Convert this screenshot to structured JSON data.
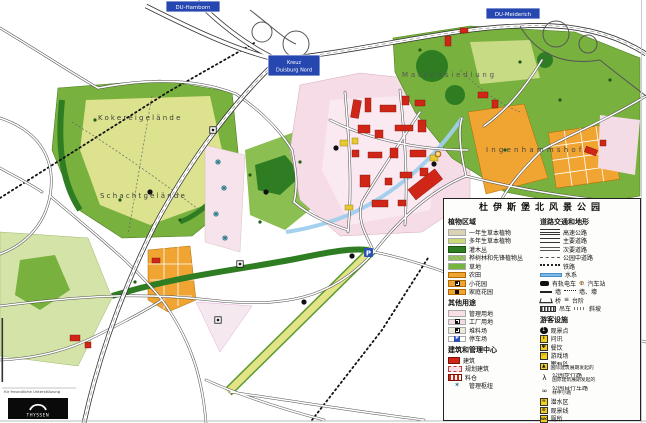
{
  "legend": {
    "title": "杜伊斯堡北风景公园",
    "plants": {
      "header": "植物区域",
      "items": [
        {
          "label": "一年生草本植物"
        },
        {
          "label": "多年生草本植物"
        },
        {
          "label": "灌木丛"
        },
        {
          "label": "桦树林和先锋植物丛"
        },
        {
          "label": "草地"
        },
        {
          "label": "农田"
        },
        {
          "label": "小花园"
        },
        {
          "label": "家庭花园"
        }
      ]
    },
    "other": {
      "header": "其他用途",
      "items": [
        {
          "label": "管理用地"
        },
        {
          "label": "工厂用地"
        },
        {
          "label": "堆料场"
        },
        {
          "label": "停车场",
          "glyph": "P"
        }
      ]
    },
    "buildings": {
      "header": "建筑和管理中心",
      "items": [
        {
          "label": "建筑"
        },
        {
          "label": "规划建筑"
        },
        {
          "label": "料仓"
        },
        {
          "label": "管理枢纽",
          "glyph": "✶"
        }
      ]
    },
    "roads": {
      "header": "道路交通和地形",
      "items": [
        {
          "label": "高速公路"
        },
        {
          "label": "主要道路"
        },
        {
          "label": "次要道路"
        },
        {
          "label": "公园中道路"
        },
        {
          "label": "铁路"
        },
        {
          "label": "水系"
        },
        {
          "label": "有轨电车",
          "label2": "汽车站",
          "glyph2": "⊕"
        },
        {
          "label": "墙",
          "label2": "墙、壕"
        },
        {
          "label": "桥",
          "label2": "台阶",
          "glyph2": "≡"
        },
        {
          "label": "吊车",
          "label2": "斜坡"
        }
      ]
    },
    "facilities": {
      "header": "游客设施",
      "items": [
        {
          "label": "观景点",
          "glyph": "1"
        },
        {
          "label": "问讯",
          "glyph": "i"
        },
        {
          "label": "餐饮",
          "glyph": "Ψ"
        },
        {
          "label": "游戏场",
          "glyph": "⚐"
        },
        {
          "label": "攀岩区",
          "sub": "国际建筑展期发起的",
          "glyph": "▲"
        },
        {
          "label": "公园步行路",
          "sub": "国际建筑展期发起的",
          "glyph": "λ"
        },
        {
          "label": "公园自行车路",
          "sub": "林中小路",
          "glyph": "∞"
        },
        {
          "label": "潜水区",
          "glyph": "≈"
        },
        {
          "label": "观景线",
          "glyph": "⊙"
        },
        {
          "label": "厕所",
          "glyph": "WC"
        }
      ]
    }
  },
  "map": {
    "labels": {
      "kokerei": "Kokereigelände",
      "schacht": "Schachtgelände",
      "siedlung": "Matenasiedlung",
      "hof": "Ingenhammshof"
    },
    "signs": {
      "top_left": "DU-Hamborn",
      "top_right": "DU-Meiderich",
      "kreuz_line1": "Kreuz",
      "kreuz_line2": "Duisburg Nord"
    },
    "credit": {
      "note": "für freundliche Unterstützung",
      "brand": "THYSSEN"
    }
  },
  "colors": {
    "sign_blue": "#2747b0",
    "park_green": "#79b13e",
    "pale_green": "#dde28e",
    "dark_green": "#2e7d22",
    "orange": "#f0a432",
    "industrial_pink": "#f5dce6",
    "building_red": "#cf2618",
    "water_blue": "#9fcfec",
    "facility_yellow": "#f2cf1d"
  }
}
